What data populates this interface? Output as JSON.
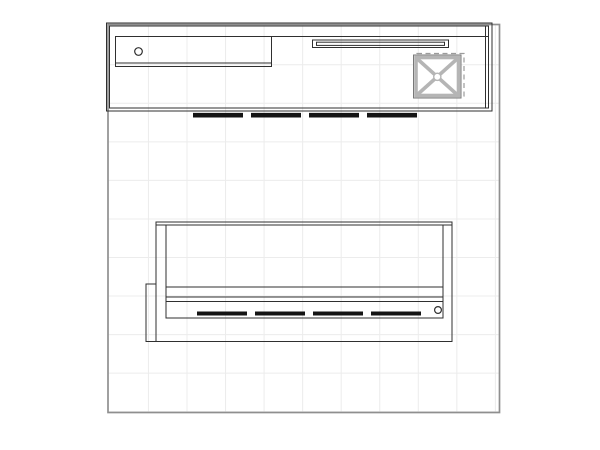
{
  "canvas": {
    "width": 600,
    "height": 450,
    "background": "#ffffff"
  },
  "colors": {
    "grid": "#ececec",
    "boundary": "#8f8f8f",
    "line": "#2f2f2f",
    "light_gray": "#b5b5b5",
    "ghost": "#9b9b9b",
    "feet": "#141414"
  },
  "drawing": {
    "kind": "exhibit-booth-floor-plan",
    "shapes": [
      {
        "t": "grid",
        "name": "floor-grid",
        "x": 108.8,
        "y": 25.3,
        "w": 390.0,
        "h": 386.5,
        "xs": [
          148.45,
          187.0,
          225.55,
          264.1,
          302.65,
          341.2,
          379.75,
          418.3,
          456.85,
          495.4
        ],
        "ys": [
          64.75,
          103.3,
          141.85,
          180.4,
          218.95,
          257.5,
          296.05,
          334.6,
          373.15,
          411.7
        ],
        "stroke": "#ececec",
        "sw": 1
      },
      {
        "t": "rect",
        "name": "floor-boundary",
        "x": 108,
        "y": 24.5,
        "w": 391.5,
        "h": 388,
        "stroke": "#8f8f8f",
        "sw": 1.7,
        "fill": "none"
      },
      {
        "t": "rect",
        "name": "top-unit-outer",
        "x": 106.5,
        "y": 23,
        "w": 385.5,
        "h": 88,
        "stroke": "#2f2f2f",
        "sw": 1,
        "fill": "none"
      },
      {
        "t": "rect",
        "name": "top-unit-inner",
        "x": 109.5,
        "y": 26,
        "w": 379,
        "h": 82,
        "stroke": "#2f2f2f",
        "sw": 1,
        "fill": "none"
      },
      {
        "t": "line",
        "name": "top-unit-right-panel-line",
        "x1": 485.5,
        "y1": 26,
        "x2": 485.5,
        "y2": 108,
        "stroke": "#2f2f2f",
        "sw": 1
      },
      {
        "t": "line",
        "name": "top-unit-divider",
        "x1": 115.5,
        "y1": 36.5,
        "x2": 488.5,
        "y2": 36.5,
        "stroke": "#2f2f2f",
        "sw": 1
      },
      {
        "t": "rect",
        "name": "storage-compartment",
        "x": 115.5,
        "y": 36.5,
        "w": 156,
        "h": 30,
        "stroke": "#2f2f2f",
        "sw": 1,
        "fill": "none"
      },
      {
        "t": "line",
        "name": "compartment-shelf-line",
        "x1": 115.5,
        "y1": 63,
        "x2": 271.5,
        "y2": 63,
        "stroke": "#2f2f2f",
        "sw": 1
      },
      {
        "t": "circle",
        "name": "grommet-hole-top",
        "cx": 138.5,
        "cy": 51.5,
        "r": 3.8,
        "stroke": "#2f2f2f",
        "sw": 1.2,
        "fill": "none"
      },
      {
        "t": "rect",
        "name": "light-shelf-outer",
        "x": 312.5,
        "y": 40,
        "w": 136,
        "h": 7.5,
        "stroke": "#2f2f2f",
        "sw": 1,
        "fill": "none"
      },
      {
        "t": "rect",
        "name": "light-shelf-inner",
        "x": 316.5,
        "y": 42.2,
        "w": 128,
        "h": 3.2,
        "stroke": "#2f2f2f",
        "sw": 1,
        "fill": "none"
      },
      {
        "t": "rect",
        "name": "crate-ghost-outline",
        "x": 417,
        "y": 53.5,
        "w": 47,
        "h": 42.5,
        "stroke": "#9b9b9b",
        "sw": 1.2,
        "dash": "5 3.5",
        "fill": "none"
      },
      {
        "t": "rect",
        "name": "crate-outline",
        "x": 413.5,
        "y": 55,
        "w": 47.5,
        "h": 43,
        "stroke": "#787878",
        "sw": 1,
        "fill": "#ffffff"
      },
      {
        "t": "rect",
        "name": "crate-frame",
        "x": 416,
        "y": 57.5,
        "w": 42.5,
        "h": 38,
        "stroke": "#b5b5b5",
        "sw": 3.6,
        "fill": "#ffffff"
      },
      {
        "t": "line",
        "name": "crate-brace-1",
        "x1": 417.5,
        "y1": 59,
        "x2": 457,
        "y2": 94.5,
        "stroke": "#b5b5b5",
        "sw": 3.6
      },
      {
        "t": "line",
        "name": "crate-brace-2",
        "x1": 457,
        "y1": 59,
        "x2": 417.5,
        "y2": 94.5,
        "stroke": "#b5b5b5",
        "sw": 3.6
      },
      {
        "t": "circle",
        "name": "crate-center-cap",
        "cx": 437.3,
        "cy": 76.8,
        "r": 3.6,
        "stroke": "#b5b5b5",
        "sw": 1.4,
        "fill": "#ffffff"
      },
      {
        "t": "line",
        "name": "top-unit-feet",
        "x1": 193,
        "y1": 115.2,
        "x2": 420,
        "y2": 115.2,
        "stroke": "#141414",
        "sw": 4.6,
        "dash": "50 8"
      },
      {
        "t": "rect",
        "name": "bottom-unit-outer",
        "x": 156,
        "y": 222,
        "w": 296,
        "h": 119.5,
        "stroke": "#2f2f2f",
        "sw": 1,
        "fill": "none"
      },
      {
        "t": "line",
        "name": "bottom-unit-top-edge",
        "x1": 156,
        "y1": 225,
        "x2": 452,
        "y2": 225,
        "stroke": "#2f2f2f",
        "sw": 1
      },
      {
        "t": "rect",
        "name": "bottom-unit-inner",
        "x": 166,
        "y": 225,
        "w": 277,
        "h": 93,
        "stroke": "#2f2f2f",
        "sw": 1,
        "fill": "none"
      },
      {
        "t": "line",
        "name": "counter-edge-1",
        "x1": 166,
        "y1": 287,
        "x2": 443,
        "y2": 287,
        "stroke": "#2f2f2f",
        "sw": 1
      },
      {
        "t": "line",
        "name": "counter-edge-2",
        "x1": 166,
        "y1": 297,
        "x2": 443,
        "y2": 297,
        "stroke": "#2f2f2f",
        "sw": 1
      },
      {
        "t": "line",
        "name": "counter-edge-3",
        "x1": 166,
        "y1": 301.5,
        "x2": 443,
        "y2": 301.5,
        "stroke": "#2f2f2f",
        "sw": 1
      },
      {
        "t": "line",
        "name": "bottom-unit-feet",
        "x1": 197,
        "y1": 313.5,
        "x2": 429,
        "y2": 313.5,
        "stroke": "#141414",
        "sw": 4,
        "dash": "50 8"
      },
      {
        "t": "circle",
        "name": "grommet-hole-bottom",
        "cx": 438,
        "cy": 310,
        "r": 3.4,
        "stroke": "#2f2f2f",
        "sw": 1.2,
        "fill": "#ffffff"
      },
      {
        "t": "rect",
        "name": "bottom-unit-wing",
        "x": 146,
        "y": 284,
        "w": 10,
        "h": 57.5,
        "stroke": "#2f2f2f",
        "sw": 1,
        "fill": "none"
      }
    ]
  }
}
